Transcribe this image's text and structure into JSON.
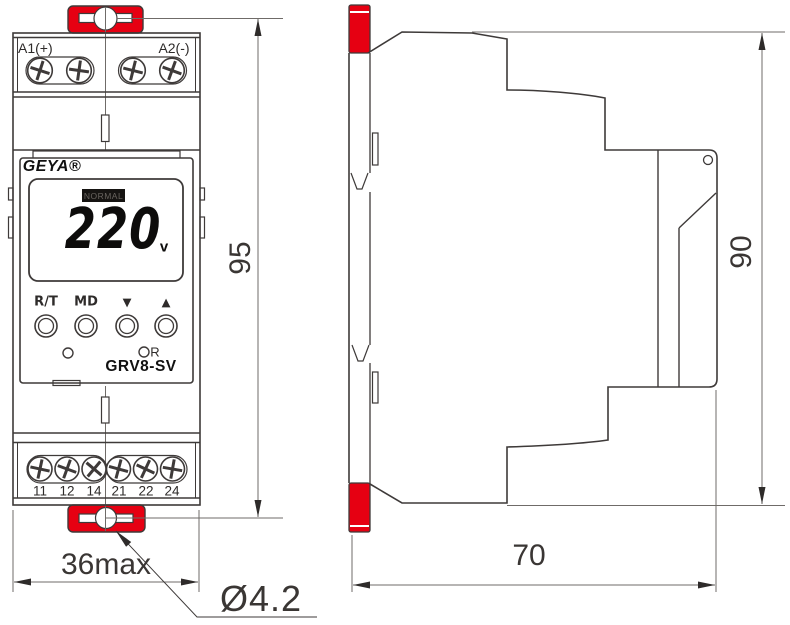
{
  "front_view": {
    "brand": "GEYA®",
    "model": "GRV8-SV",
    "top_terminals": {
      "left": "A1(+)",
      "right": "A2(-)"
    },
    "display": {
      "status": "NORMAL",
      "value": "220",
      "unit": "v"
    },
    "buttons": [
      "R/T",
      "MD",
      "▼",
      "▲"
    ],
    "reset_indicator_label": "R",
    "bottom_terminals": [
      "11",
      "12",
      "14",
      "21",
      "22",
      "24"
    ]
  },
  "dimensions": {
    "front_height": "95",
    "front_width": "36max",
    "mount_hole_diameter": "Ø4.2",
    "side_height": "90",
    "side_depth": "70"
  },
  "colors": {
    "clip_red": "#e60012",
    "outline": "#3e3a39",
    "dim_line": "#6f6b68"
  }
}
